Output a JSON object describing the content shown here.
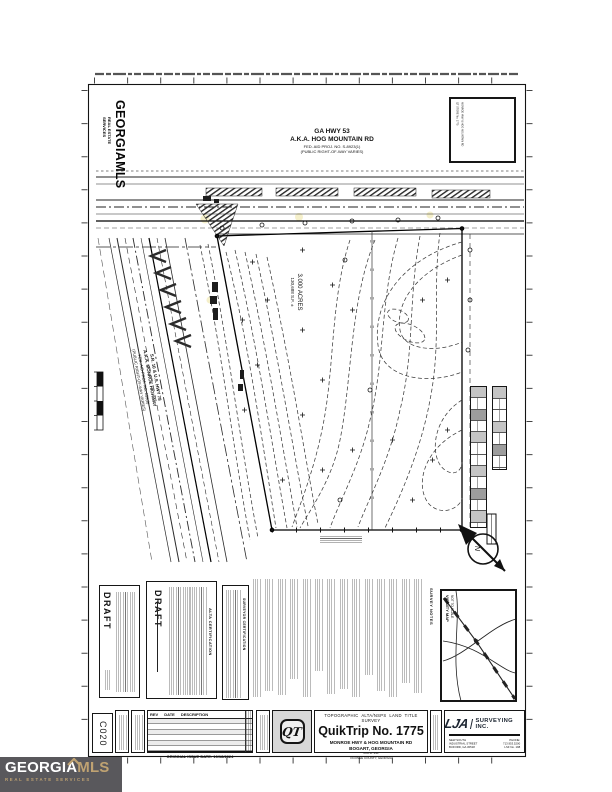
{
  "watermark": {
    "brand": "GEORGIAMLS",
    "sub": "REAL ESTATE SERVICES"
  },
  "footer_logo": {
    "part1": "GEORGIA",
    "part2": "MLS",
    "tagline": "REAL ESTATE SERVICES"
  },
  "roads": {
    "hog_mountain": {
      "l1": "GA HWY 53",
      "l2": "A.K.A. HOG MOUNTAIN RD",
      "l3": "FED. AID PROJ. NO. S-8923(1)",
      "l4": "(PUBLIC RIGHT-OF-WAY VARIES)"
    },
    "monroe": {
      "l1": "S.R. 10 & U.S. HWY 78",
      "l2": "A.K.A. MONROE HIGHWAY",
      "l3": "FED. AID PROJ. NO. 253(8)",
      "l4": "(PUBLIC RIGHT-OF-WAY VARIES)"
    }
  },
  "parcel": {
    "area_acres": "3.000 ACRES",
    "area_sf": "130,688 S.F. ±"
  },
  "compass": {
    "north": "N"
  },
  "seal_box": {
    "note1": "QT STORE No. 1775",
    "note2": "MONROE HWY & HOG MOUNTAIN RD"
  },
  "certs": {
    "draft_stamp": "DRAFT",
    "alta_heading": "ALTA CERTIFICATION",
    "surveyor_heading": "SURVEYOR CERTIFICATION",
    "notes_heading": "SURVEY NOTES"
  },
  "vicinity": {
    "title": "VICINITY MAP",
    "scale": "NOT TO SCALE"
  },
  "title_block": {
    "sheet_no": "C020",
    "survey_type": "TOPOGRAPHIC ALTA/NSPS LAND TITLE SURVEY",
    "project": "QuikTrip No. 1775",
    "address": "MONROE HWY & HOG MOUNTAIN RD",
    "city": "BOGART, GEORGIA",
    "gmd": "G.M.D. 241",
    "county": "OCONEE COUNTY, GEORGIA",
    "qt_monogram": "QT"
  },
  "revisions": {
    "col_rev": "REV",
    "col_date": "DATE",
    "col_desc": "DESCRIPTION",
    "issue": "ORIGINAL ISSUE DATE: 10/18/2024"
  },
  "firm": {
    "name": "LJA",
    "suffix": "SURVEYING INC.",
    "addr1": "NEW SOUTH INDUSTRIAL STREET",
    "addr2": "BUFORD, GA 30518",
    "phone": "PHONE: 713.953.5200",
    "lsf": "LSF No. 198"
  }
}
